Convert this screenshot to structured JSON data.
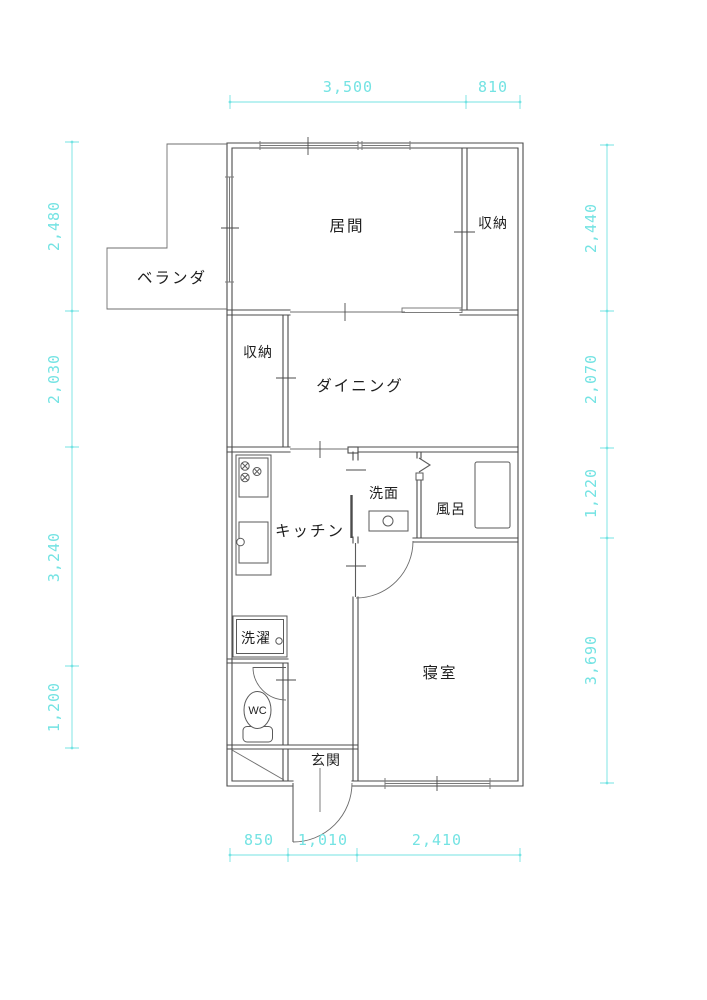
{
  "meta": {
    "drawing_type": "apartment floor plan",
    "unit": "mm"
  },
  "colors": {
    "dimension": "#74e3e3",
    "wall": "#4b4b4b"
  },
  "rooms": {
    "living": {
      "label": "居間"
    },
    "closet_upper": {
      "label": "収納"
    },
    "veranda": {
      "label": "ベランダ"
    },
    "closet_lower": {
      "label": "収納"
    },
    "dining": {
      "label": "ダイニング"
    },
    "kitchen": {
      "label": "キッチン"
    },
    "washroom": {
      "label": "洗面"
    },
    "bath": {
      "label": "風呂"
    },
    "laundry": {
      "label": "洗濯"
    },
    "wc": {
      "label": "WC"
    },
    "entrance": {
      "label": "玄関"
    },
    "bedroom": {
      "label": "寝室"
    }
  },
  "dimensions": {
    "top": [
      {
        "label": "3,500",
        "mm": 3500
      },
      {
        "label": "810",
        "mm": 810
      }
    ],
    "left": [
      {
        "label": "2,480",
        "mm": 2480
      },
      {
        "label": "2,030",
        "mm": 2030
      },
      {
        "label": "3,240",
        "mm": 3240
      },
      {
        "label": "1,200",
        "mm": 1200
      }
    ],
    "right": [
      {
        "label": "2,440",
        "mm": 2440
      },
      {
        "label": "2,070",
        "mm": 2070
      },
      {
        "label": "1,220",
        "mm": 1220
      },
      {
        "label": "3,690",
        "mm": 3690
      }
    ],
    "bottom": [
      {
        "label": "850",
        "mm": 850
      },
      {
        "label": "1,010",
        "mm": 1010
      },
      {
        "label": "2,410",
        "mm": 2410
      }
    ]
  }
}
